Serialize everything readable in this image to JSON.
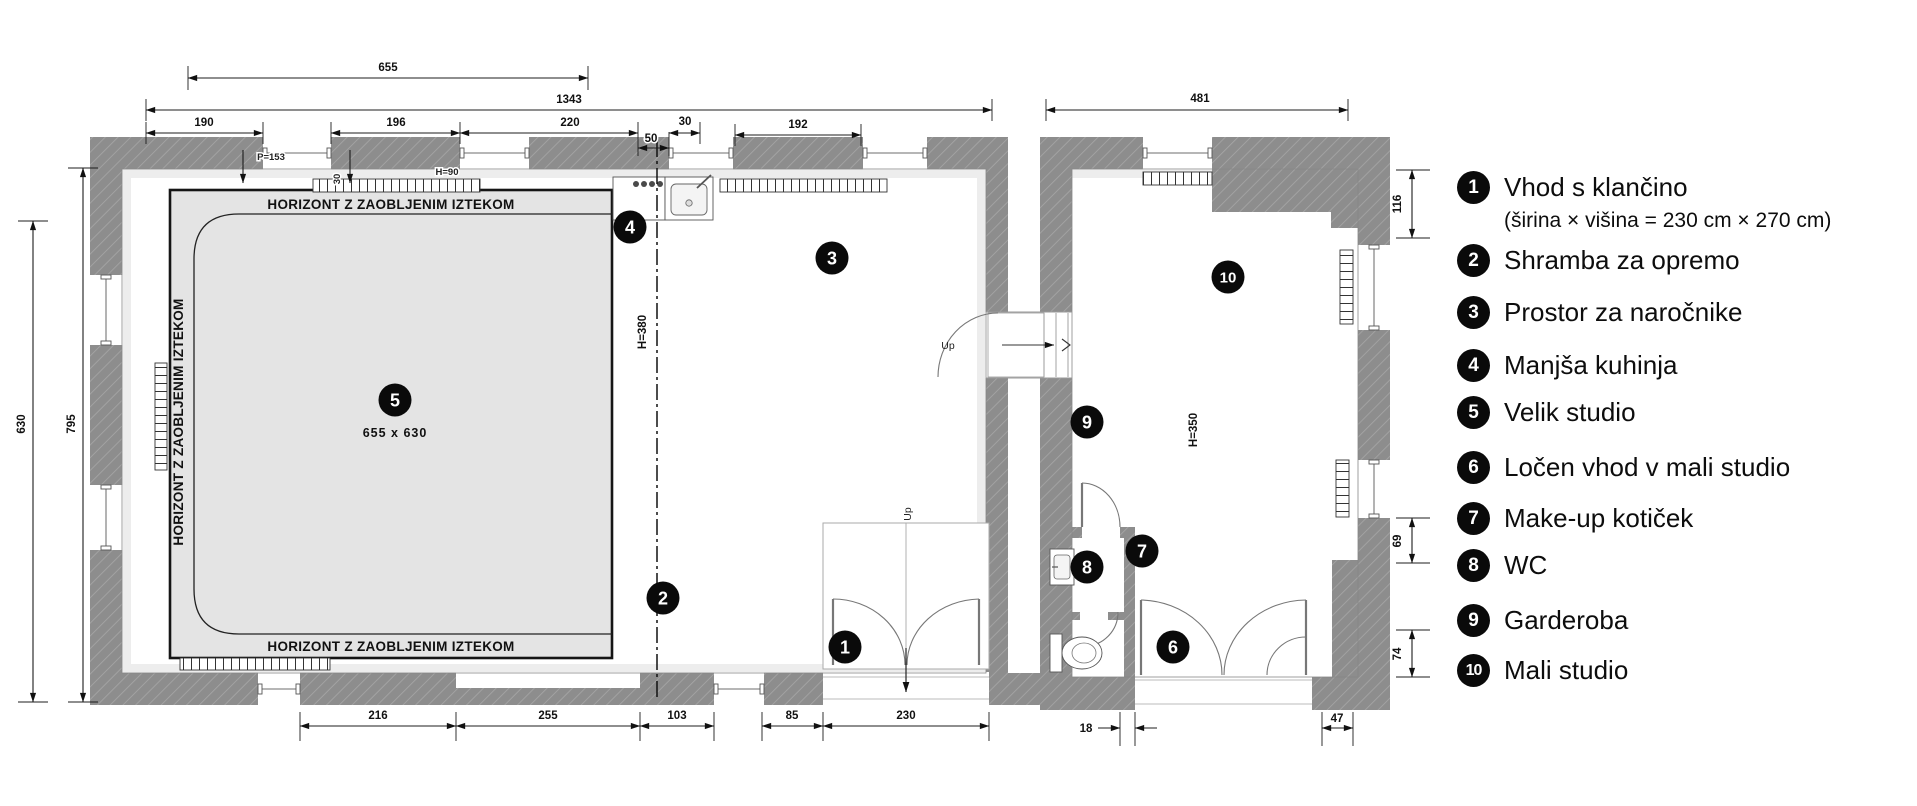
{
  "legend": {
    "items": [
      {
        "num": "1",
        "label": "Vhod s klančino",
        "sublabel": "(širina × višina = 230 cm × 270 cm)"
      },
      {
        "num": "2",
        "label": "Shramba za opremo"
      },
      {
        "num": "3",
        "label": "Prostor za naročnike"
      },
      {
        "num": "4",
        "label": "Manjša kuhinja"
      },
      {
        "num": "5",
        "label": "Velik studio"
      },
      {
        "num": "6",
        "label": "Ločen vhod v mali studio"
      },
      {
        "num": "7",
        "label": "Make-up kotiček"
      },
      {
        "num": "8",
        "label": "WC"
      },
      {
        "num": "9",
        "label": "Garderoba"
      },
      {
        "num": "10",
        "label": "Mali studio"
      }
    ]
  },
  "plan": {
    "dims": {
      "t655": "655",
      "t1343": "1343",
      "t190": "190",
      "t196": "196",
      "t220": "220",
      "t50": "50",
      "t30": "30",
      "t192": "192",
      "t481": "481",
      "l630": "630",
      "l795": "795",
      "b216": "216",
      "b255": "255",
      "b103": "103",
      "b85": "85",
      "b230": "230",
      "b18": "18",
      "b47": "47",
      "r116": "116",
      "r69": "69",
      "r74": "74",
      "v30": "30"
    },
    "texts": {
      "horizont": "HORIZONT Z ZAOBLJENIM IZTEKOM",
      "studio_size": "655 x 630",
      "h380": "H=380",
      "h350": "H=350",
      "h90": "H=90",
      "p153": "P=153",
      "up": "Up"
    },
    "colors": {
      "wall": "#8d8d8d",
      "wall_hatch": "#a7a7a7",
      "cyclorama": "#e4e4e4",
      "marker": "#0a0a0a",
      "marker_text": "#ffffff"
    }
  }
}
